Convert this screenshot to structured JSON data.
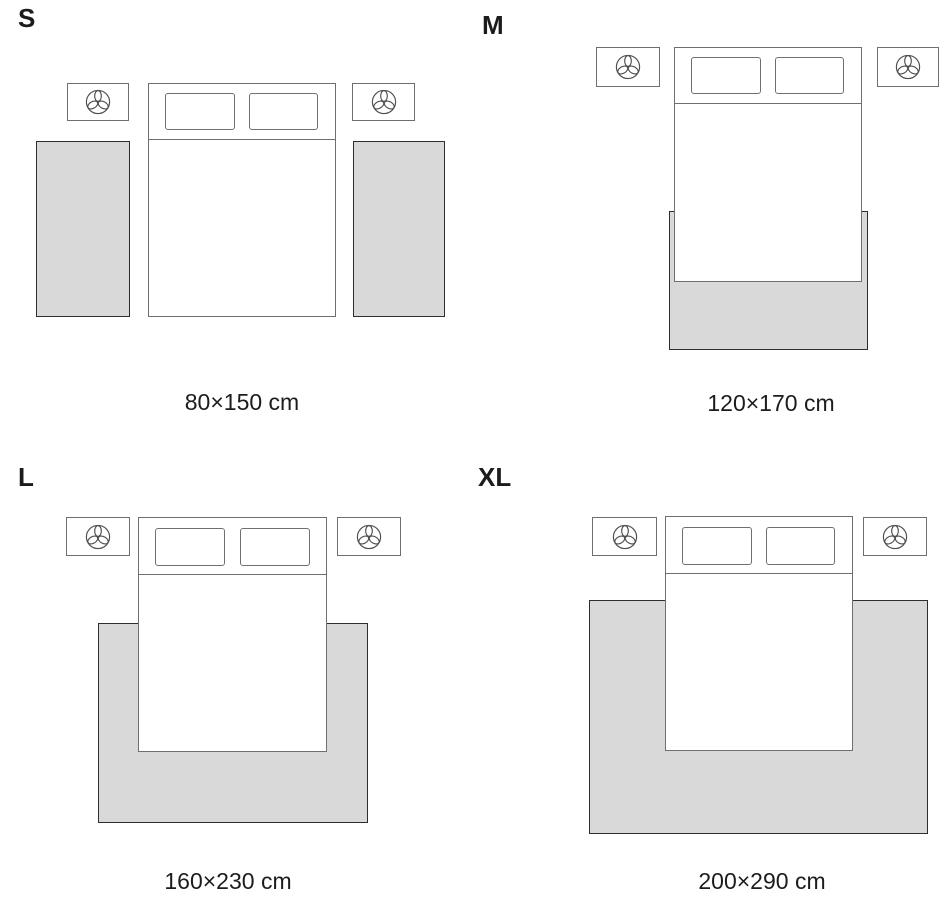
{
  "colors": {
    "background": "#ffffff",
    "text": "#1c1c1c",
    "rug_fill": "#d9d9d9",
    "rug_border": "#2e2e2e",
    "furniture_border": "#6f6f6f",
    "icon_stroke": "#4f4f4f"
  },
  "icons": {
    "nightstand_decor": "plant-icon"
  },
  "sizes": [
    {
      "id": "S",
      "label": "S",
      "dimensions": "80×150 cm"
    },
    {
      "id": "M",
      "label": "M",
      "dimensions": "120×170 cm"
    },
    {
      "id": "L",
      "label": "L",
      "dimensions": "160×230 cm"
    },
    {
      "id": "XL",
      "label": "XL",
      "dimensions": "200×290 cm"
    }
  ]
}
